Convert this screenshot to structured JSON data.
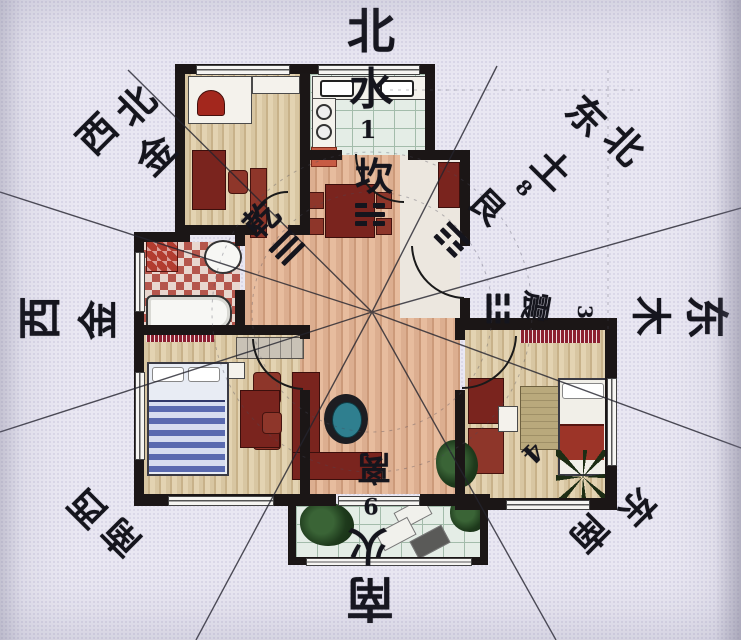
{
  "compass": {
    "north": "北",
    "south": "南",
    "east": "东",
    "west": "西",
    "northwest": [
      "西",
      "北"
    ],
    "northeast": [
      "东",
      "北"
    ],
    "southwest": [
      "西",
      "南"
    ],
    "southeast": [
      "东",
      "南"
    ]
  },
  "elements": {
    "water": "水",
    "metal": "金",
    "wood": "木",
    "earth": "土",
    "fire": "火"
  },
  "trigrams": {
    "qian": "乾",
    "kan": "坎",
    "gen": "艮",
    "zhen": "震",
    "li": "离"
  },
  "numbers": {
    "north": "1",
    "northeast": "8",
    "east": "3",
    "south": "9",
    "southeast_room": "4"
  },
  "colors": {
    "wall": "#1b1616",
    "label_ink": "#15151d",
    "living_floor": "#dcae90",
    "wood_floor": "#d8c6a2",
    "tile_floor": "#e4ede6",
    "accent_red": "#7a241e"
  }
}
